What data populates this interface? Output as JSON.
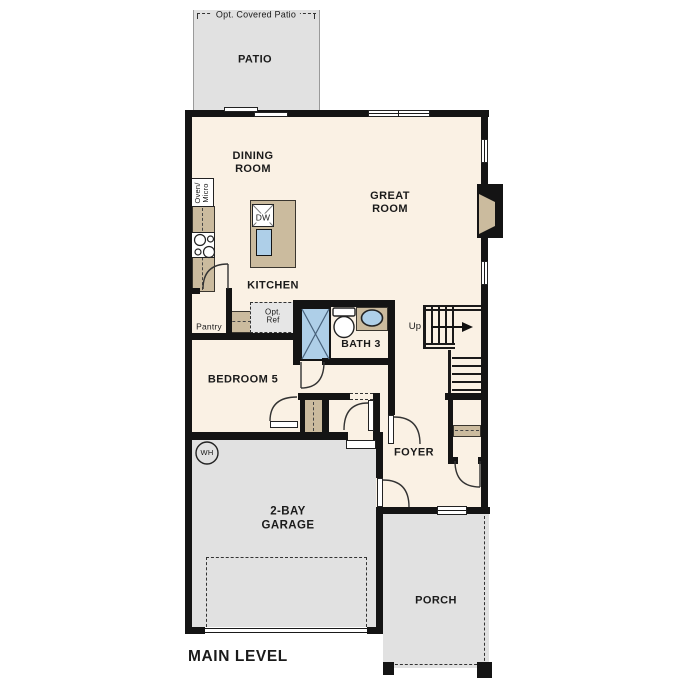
{
  "plan": {
    "title": "MAIN LEVEL",
    "rooms": {
      "patio": "PATIO",
      "dining": "DINING ROOM",
      "great": "GREAT ROOM",
      "kitchen": "KITCHEN",
      "bath3": "BATH 3",
      "bedroom5": "BEDROOM 5",
      "foyer": "FOYER",
      "garage": "2-BAY GARAGE",
      "porch": "PORCH"
    },
    "annotations": {
      "opt_covered_patio": "Opt. Covered Patio",
      "oven_micro": "Oven/ Micro",
      "dw": "DW",
      "pantry": "Pantry",
      "opt_ref": "Opt. Ref",
      "up": "Up",
      "wh": "WH"
    },
    "colors": {
      "wall": "#141414",
      "floor": "#faf1e4",
      "hardscape": "#e1e1e1",
      "counter": "#cbbb9e",
      "fixture_blue": "#aecfe8"
    }
  }
}
